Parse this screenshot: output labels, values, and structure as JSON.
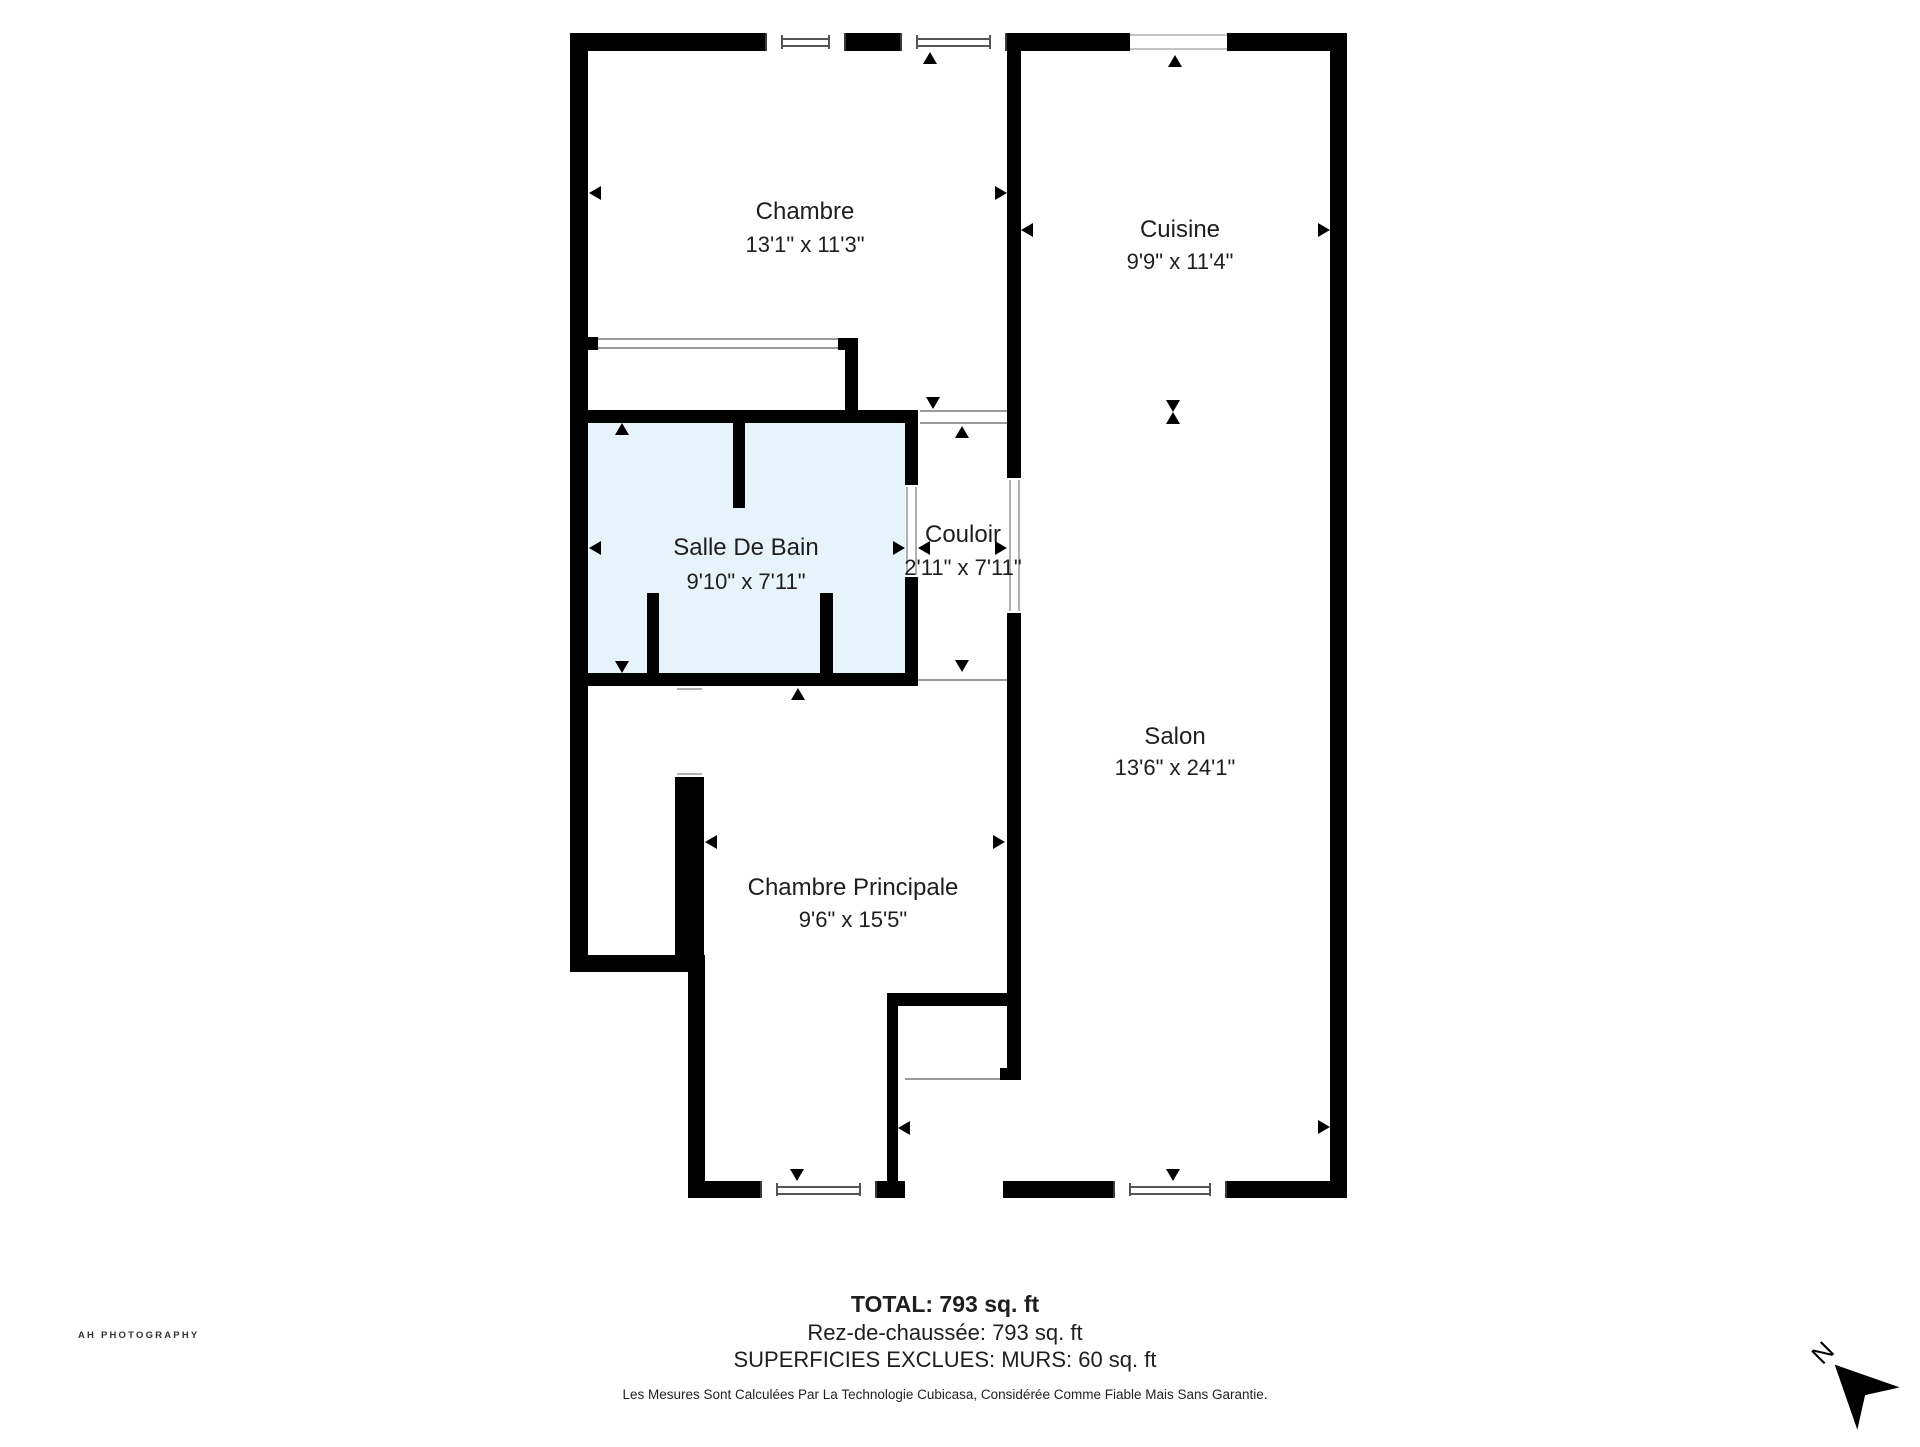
{
  "plan": {
    "rooms": {
      "chambre": {
        "name": "Chambre",
        "dims": "13'1\" x 11'3\""
      },
      "cuisine": {
        "name": "Cuisine",
        "dims": "9'9\" x 11'4\""
      },
      "salle_de_bain": {
        "name": "Salle De Bain",
        "dims": "9'10\" x 7'11\""
      },
      "couloir": {
        "name": "Couloir",
        "dims": "2'11\" x 7'11\""
      },
      "salon": {
        "name": "Salon",
        "dims": "13'6\" x 24'1\""
      },
      "chambre_principale": {
        "name": "Chambre Principale",
        "dims": "9'6\" x 15'5\""
      }
    },
    "compass_label": "N"
  },
  "footer": {
    "total": "TOTAL: 793 sq. ft",
    "floor": "Rez-de-chaussée: 793 sq. ft",
    "excluded": "SUPERFICIES EXCLUES: MURS: 60 sq. ft",
    "disclaimer": "Les Mesures Sont Calculées Par La Technologie Cubicasa, Considérée Comme Fiable Mais Sans Garantie."
  },
  "branding": {
    "logo_text": "AH PHOTOGRAPHY"
  },
  "icons": {
    "north-arrow": "solid black dart pointing toward rotated N (north)",
    "measure-arrow": "small black triangle dimension marker",
    "window": "white bar with double frame lines inside wall"
  },
  "colors": {
    "wall": "#000000",
    "bathroom_fill": "#e7f3fb",
    "label_text": "#1e1e1e",
    "opening_line": "#9a9a9a",
    "window_frame": "#4a4a4a",
    "background": "#ffffff"
  }
}
